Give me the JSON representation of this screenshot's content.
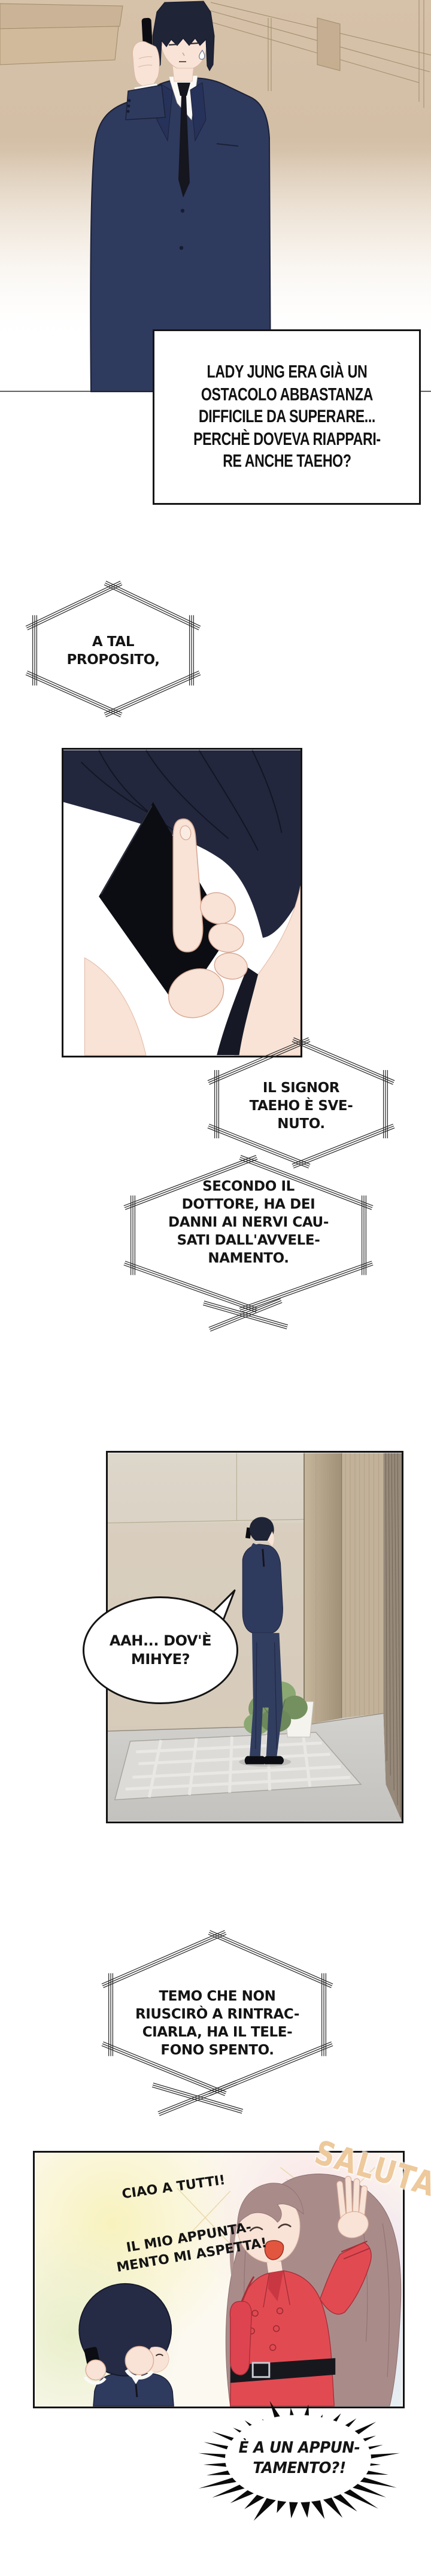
{
  "comic": {
    "caption": "LADY JUNG ERA GIÀ UN\nOSTACOLO ABBASTANZA\nDIFFICILE DA SUPERARE...\nPERCHÈ DOVEVA RIAPPARI-\nRE ANCHE TAEHO?",
    "bubble_proposito": "A TAL\nPROPOSITO,",
    "bubble_svenuto": "IL SIGNOR\nTAEHO È SVE-\nNUTO.",
    "bubble_dottore": "SECONDO IL\nDOTTORE, HA DEI\nDANNI AI NERVI CAU-\nSATI DALL'AVVELE-\nNAMENTO.",
    "bubble_dove": "AAH... DOV'È\nMIHYE?",
    "bubble_temo": "TEMO CHE NON\nRIUSCIRÒ A RINTRAC-\nCIARLA, HA IL TELE-\nFONO SPENTO.",
    "speech_ciao": "CIAO A TUTTI!",
    "speech_appuntamento": "IL MIO APPUNTA-\nMENTO MI ASPETTA!",
    "sfx_saluta": "SALUTA",
    "burst_text": "È A UN APPUN-\nTAMENTO?!"
  },
  "colors": {
    "ink": "#141414",
    "suit_navy": "#2f3a5f",
    "hair_dark": "#1f2437",
    "hair_brown": "#a98c8a",
    "skin": "#f8e3d6",
    "coat_red": "#e24a52",
    "belt_black": "#17181d",
    "saluta_tan": "#edc99c",
    "wall_beige": "#d7c2a8",
    "floor_gray": "#c9c8c4"
  }
}
